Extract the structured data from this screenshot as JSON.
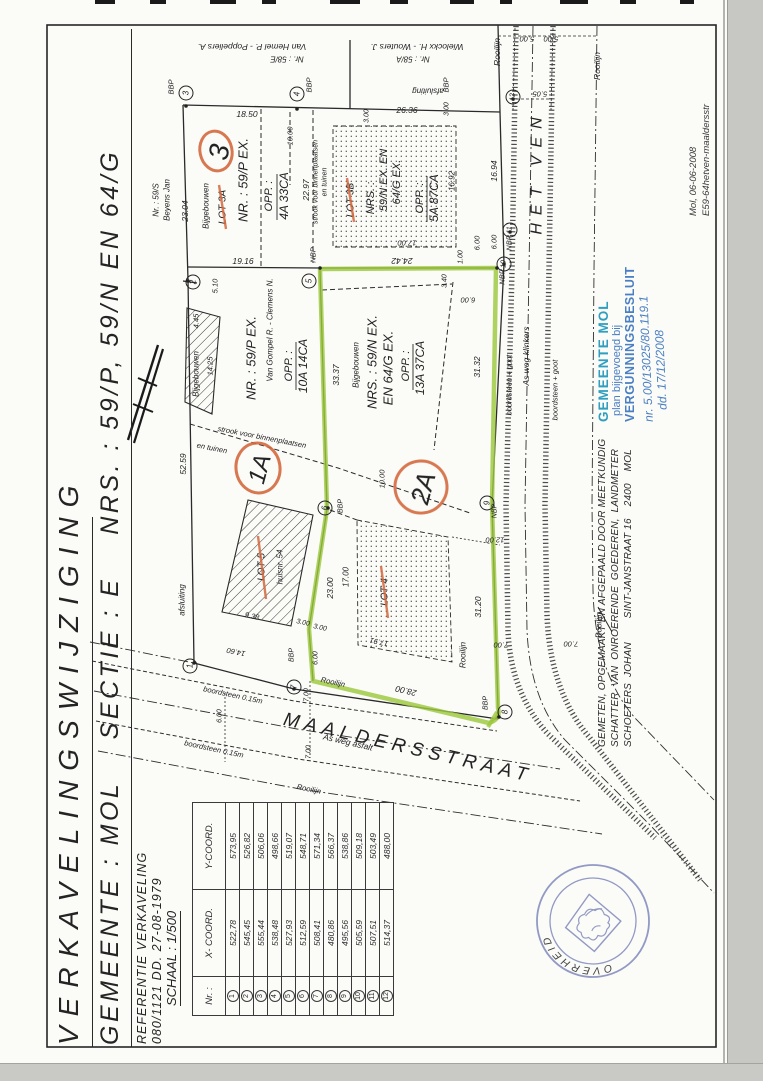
{
  "document": {
    "title": "VERKAVELINGSWIJZIGING",
    "subtitle": "GEMEENTE : MOL    SECTIE : E    NRS. : 59/P, 59/N EN 64/G",
    "reference_line1": "REFERENTIE VERKAVELING",
    "reference_line2": "080/1121 DD. 27-08-1979",
    "scale": "SCHAAL : 1/500"
  },
  "coord_table": {
    "headers": {
      "nr": "Nr. :",
      "x": "X- COORD.",
      "y": "Y-COORD."
    },
    "rows": [
      {
        "nr": "1",
        "x": "522,78",
        "y": "573,95"
      },
      {
        "nr": "2",
        "x": "545,45",
        "y": "526,82"
      },
      {
        "nr": "3",
        "x": "555,44",
        "y": "506,06"
      },
      {
        "nr": "4",
        "x": "538,48",
        "y": "498,66"
      },
      {
        "nr": "5",
        "x": "527,93",
        "y": "519,07"
      },
      {
        "nr": "6",
        "x": "512,59",
        "y": "548,71"
      },
      {
        "nr": "7",
        "x": "508,41",
        "y": "571,34"
      },
      {
        "nr": "8",
        "x": "480,86",
        "y": "566,37"
      },
      {
        "nr": "9",
        "x": "495,56",
        "y": "538,86"
      },
      {
        "nr": "10",
        "x": "505,59",
        "y": "509,18"
      },
      {
        "nr": "11",
        "x": "507,51",
        "y": "503,49"
      },
      {
        "nr": "12",
        "x": "514,37",
        "y": "488,00"
      }
    ]
  },
  "plan": {
    "points": [
      "1",
      "2",
      "3",
      "4",
      "5",
      "6",
      "7",
      "8",
      "9",
      "10",
      "11",
      "12"
    ],
    "lot_markers": {
      "m3": "3",
      "m1a": "1A",
      "m2a": "2A"
    },
    "labels": [
      {
        "t": "Van Hemel P. - Poppeliers A."
      },
      {
        "t": "Nr. : 58/E"
      },
      {
        "t": "Wielockx H. - Wouters J."
      },
      {
        "t": "Nr. : 58/A"
      },
      {
        "t": "afsluiting"
      },
      {
        "t": "Rooilijn"
      },
      {
        "t": "Rooilijn"
      },
      {
        "t": "5.00"
      },
      {
        "t": "5.00"
      },
      {
        "t": "5.05"
      },
      {
        "t": "BBP"
      },
      {
        "t": "BBP"
      },
      {
        "t": "BBP"
      },
      {
        "t": "Nr. : 59/S"
      },
      {
        "t": "Beyens Jan"
      },
      {
        "t": "18.50"
      },
      {
        "t": "23.04"
      },
      {
        "t": "19.16"
      },
      {
        "t": "Bijgebouwen"
      },
      {
        "t": "LOT 3A"
      },
      {
        "t": "NR. : 59/P EX."
      },
      {
        "t": "OPP. :"
      },
      {
        "t": "4A 33CA"
      },
      {
        "t": "10.00"
      },
      {
        "t": "22.97"
      },
      {
        "t": "strook voor binnenplaatsen"
      },
      {
        "t": "en tuinen"
      },
      {
        "t": "NBP"
      },
      {
        "t": "LOT 3B"
      },
      {
        "t": "NRS. :"
      },
      {
        "t": "59/N EX.  EN"
      },
      {
        "t": "64/G EX."
      },
      {
        "t": "OPP. :"
      },
      {
        "t": "5A 87CA"
      },
      {
        "t": "26.36"
      },
      {
        "t": "3.00"
      },
      {
        "t": "3.00"
      },
      {
        "t": "16.92"
      },
      {
        "t": "16.94"
      },
      {
        "t": "17.00"
      },
      {
        "t": "6.00"
      },
      {
        "t": "6.00"
      },
      {
        "t": "24.42"
      },
      {
        "t": "1.00"
      },
      {
        "t": "NBP"
      },
      {
        "t": "NBP"
      },
      {
        "t": "5.10"
      },
      {
        "t": "4.45"
      },
      {
        "t": "14.25"
      },
      {
        "t": "Bijgebouwen"
      },
      {
        "t": "NR. : 59/P EX."
      },
      {
        "t": "Van Gompel R. - Clemens N."
      },
      {
        "t": "OPP. :"
      },
      {
        "t": "10A 14CA"
      },
      {
        "t": "52.59"
      },
      {
        "t": "strook voor binnenplaatsen"
      },
      {
        "t": "en tuinen"
      },
      {
        "t": "33.37"
      },
      {
        "t": "Bijgebouwen"
      },
      {
        "t": "NRS. : 59/N EX."
      },
      {
        "t": "EN 64/G EX."
      },
      {
        "t": "OPP. :"
      },
      {
        "t": "13A 37CA"
      },
      {
        "t": "3.40"
      },
      {
        "t": "6.00"
      },
      {
        "t": "31.32"
      },
      {
        "t": "10.00"
      },
      {
        "t": "boordsteen + goot"
      },
      {
        "t": "As weg klinkers"
      },
      {
        "t": "boordsteen + goot"
      },
      {
        "t": "HET VEN"
      },
      {
        "t": "LOT 5"
      },
      {
        "t": "huisnr. 54"
      },
      {
        "t": "9.38"
      },
      {
        "t": "3.00"
      },
      {
        "t": "3.00"
      },
      {
        "t": "23.00"
      },
      {
        "t": "17.00"
      },
      {
        "t": "afsluiting"
      },
      {
        "t": "14.60"
      },
      {
        "t": "BBP"
      },
      {
        "t": "6.00"
      },
      {
        "t": "7.00"
      },
      {
        "t": "7.00"
      },
      {
        "t": "6.00"
      },
      {
        "t": "boordsteen 0.15m"
      },
      {
        "t": "boordsteen 0.15m"
      },
      {
        "t": "LOT 4"
      },
      {
        "t": "17.91"
      },
      {
        "t": "28.00"
      },
      {
        "t": "31.20"
      },
      {
        "t": "12.00"
      },
      {
        "t": "7.00"
      },
      {
        "t": "7.00"
      },
      {
        "t": "Rooilijn"
      },
      {
        "t": "Rooilijn"
      },
      {
        "t": "Rooilijn"
      },
      {
        "t": "MAALDERSSTRAAT"
      },
      {
        "t": "As weg asfalt"
      },
      {
        "t": "Rooilijn"
      },
      {
        "t": "NBP"
      },
      {
        "t": "BBP"
      },
      {
        "t": "BBP"
      }
    ]
  },
  "stamps": {
    "municipal": {
      "line1": "GEMEENTE MOL",
      "line2": "plan bijgevoegd bij",
      "line3": "VERGUNNINGSBESLUIT",
      "line4": "nr. 5.00/13025/80.119.1",
      "line5": "dd. 17/12/2008"
    },
    "round": {
      "text": "VLAAMSE OVERHEID"
    }
  },
  "surveyor_note": {
    "line1": "GEMETEN, OPGEMAAKT EN AFGEPAALD DOOR MEETKUNDIG",
    "line2": "SCHATTER  VAN  ONROERENDE  GOEDEREN,  LANDMETER",
    "line3": "SCHOETERS  JOHAN        SINT-JANSTRAAT 16    2400    MOL"
  },
  "corner_note": {
    "line1": "Mol, 06-06-2008",
    "line2": "E59-64hetven-maaldersstr"
  },
  "colors": {
    "highlight_green": "#9cc83e",
    "marker_orange": "#d4693e",
    "stamp_blue": "#4a7fc4",
    "stamp_teal": "#2e9fc0",
    "round_stamp_blue": "#8089bb"
  }
}
